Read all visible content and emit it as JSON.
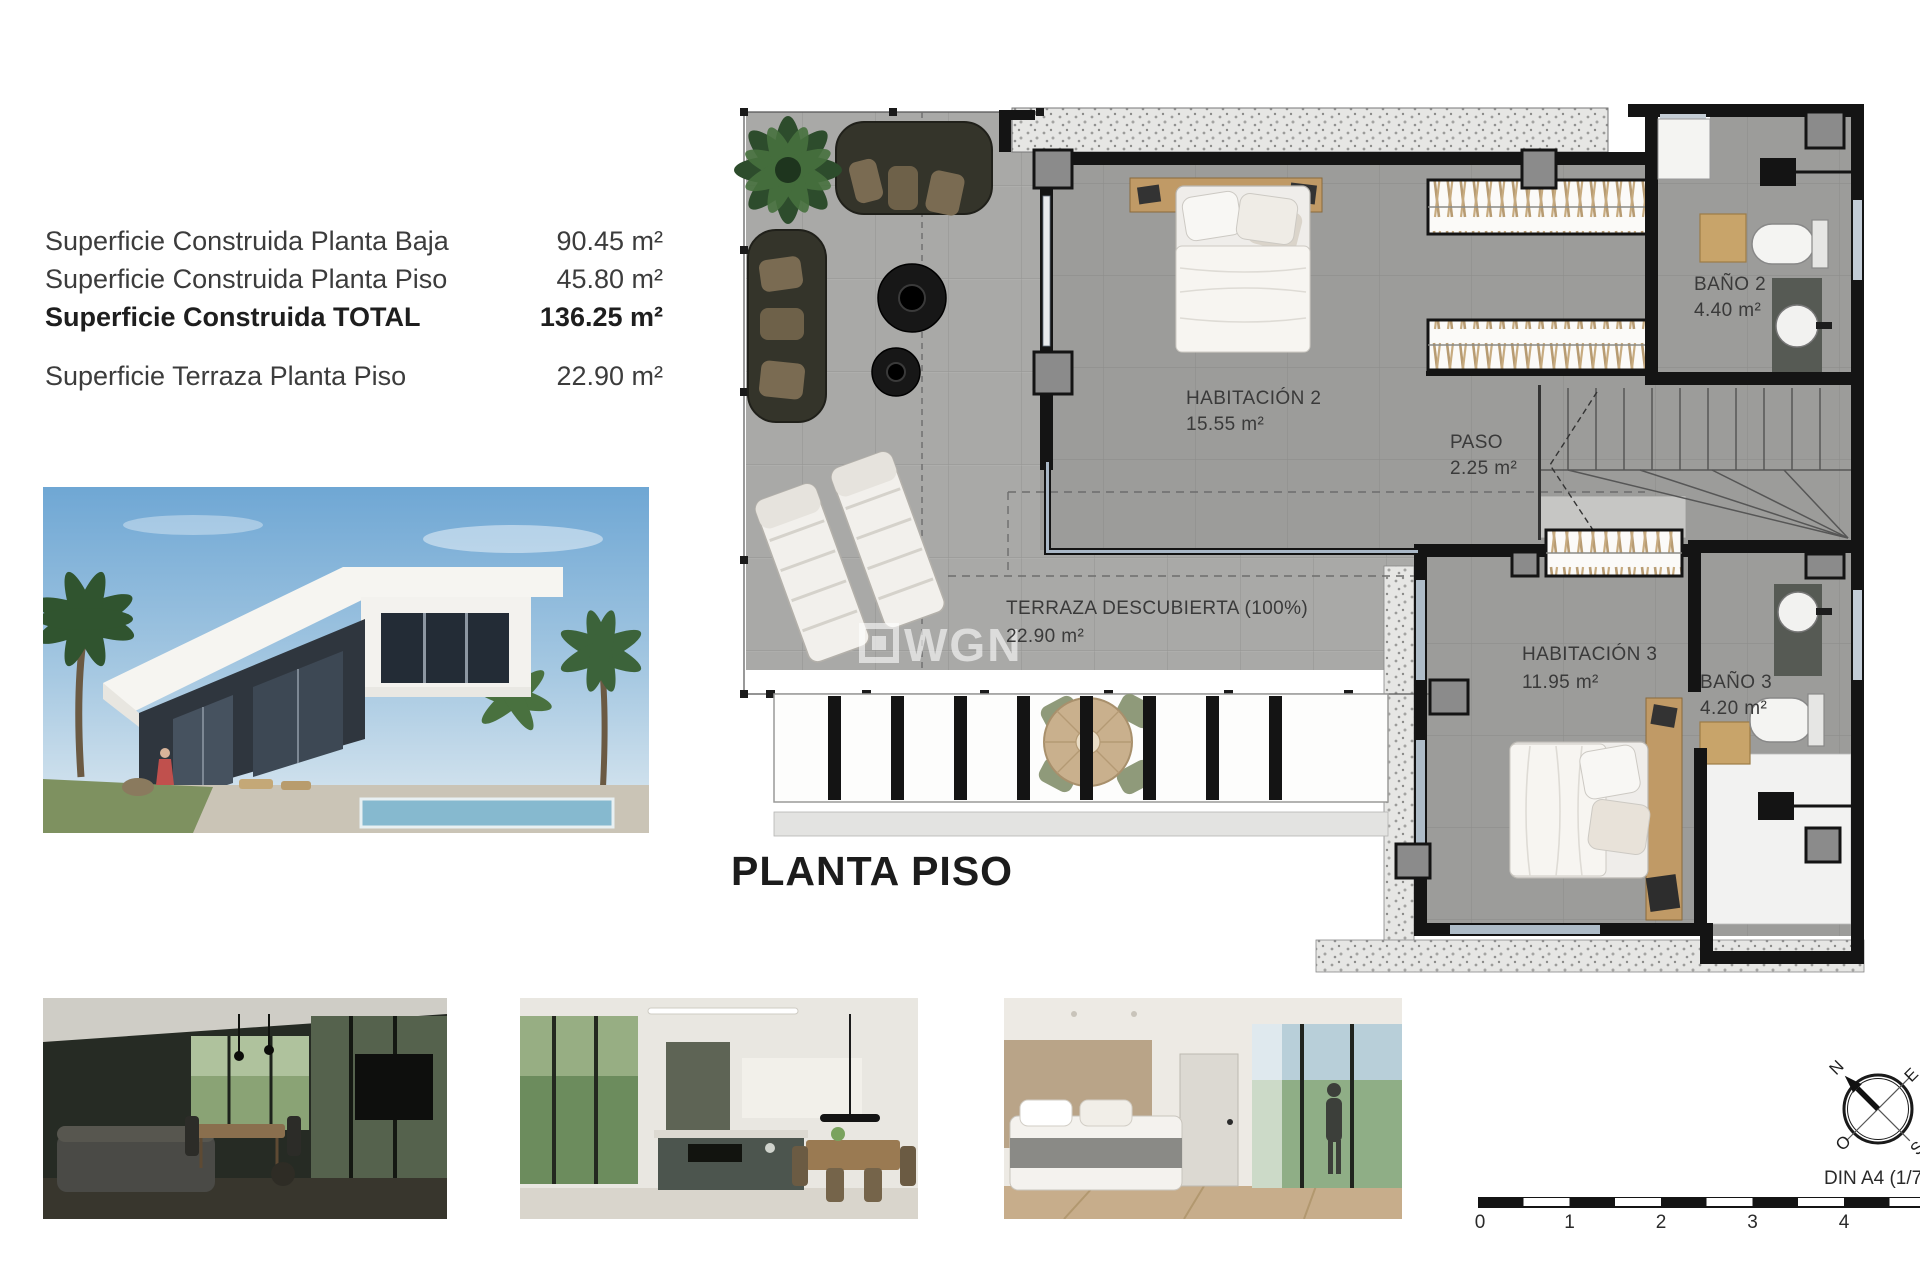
{
  "surface_table": {
    "rows": [
      {
        "label": "Superficie Construida Planta Baja",
        "value": "90.45 m²"
      },
      {
        "label": "Superficie Construida Planta Piso",
        "value": "45.80 m²"
      },
      {
        "label": "Superficie Construida TOTAL",
        "value": "136.25 m²"
      },
      {
        "label": "Superficie Terraza Planta Piso",
        "value": "22.90 m²"
      }
    ]
  },
  "plan": {
    "title": "PLANTA PISO",
    "watermark_text": "WGN",
    "rooms": {
      "habitacion2": {
        "name": "HABITACIÓN 2",
        "area": "15.55 m²"
      },
      "paso": {
        "name": "PASO",
        "area": "2.25 m²"
      },
      "bano2": {
        "name": "BAÑO 2",
        "area": "4.40 m²"
      },
      "habitacion3": {
        "name": "HABITACIÓN 3",
        "area": "11.95 m²"
      },
      "bano3": {
        "name": "BAÑO 3",
        "area": "4.20 m²"
      },
      "terraza": {
        "name": "TERRAZA DESCUBIERTA (100%)",
        "area": "22.90 m²"
      }
    }
  },
  "scale_bar": {
    "label": "DIN A4 (1/75)",
    "ticks": [
      "0",
      "1",
      "2",
      "3",
      "4"
    ]
  },
  "compass": {
    "north": "N",
    "east": "E",
    "west": "O",
    "south": "S"
  },
  "colors": {
    "wall": "#141414",
    "indoor_floor": "#9c9c9a",
    "terrace_floor": "#a9a9a7",
    "wood": "#c09a66",
    "window_line": "#a9b7c6",
    "gravel_bg": "#e6e6e4",
    "fixture_white": "#f4f4f2",
    "counter_dark": "#565a54"
  }
}
